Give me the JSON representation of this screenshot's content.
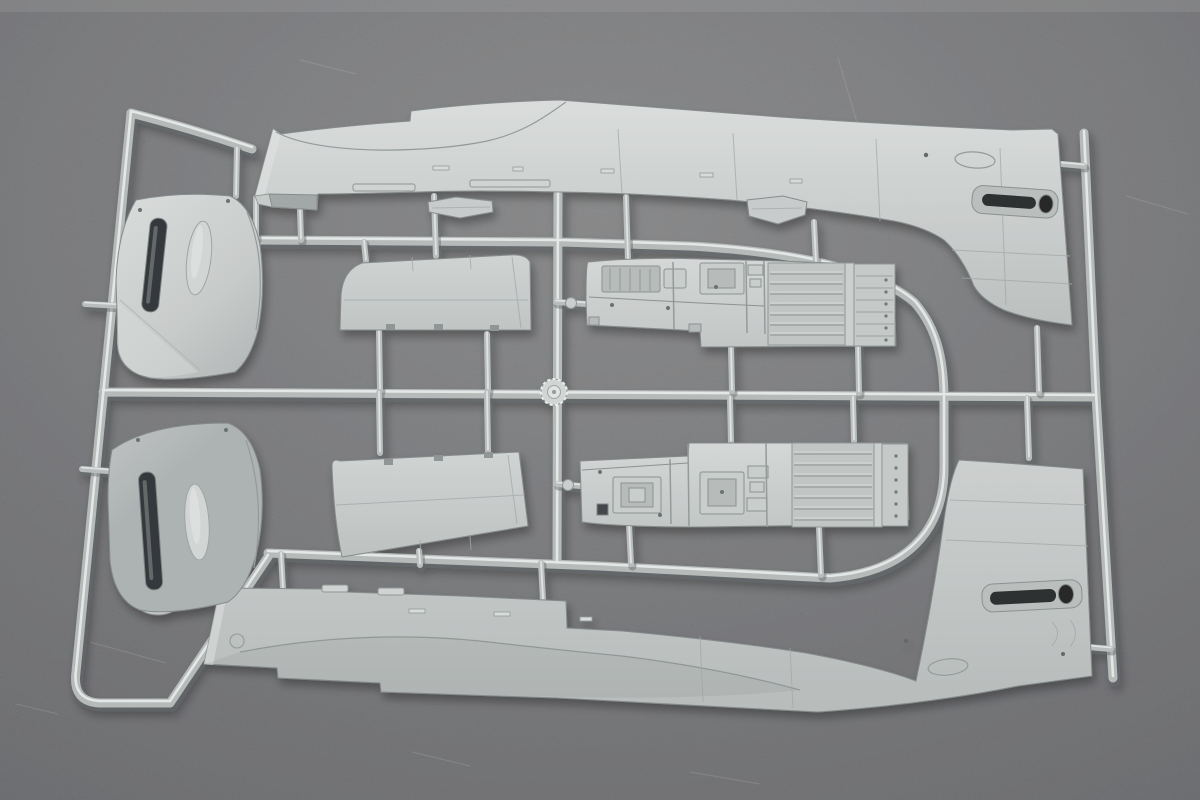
{
  "meta": {
    "domain": "natural-image",
    "type": "product-photograph",
    "subject": "Unassembled plastic scale-model aircraft kit sprue (injection-moulded runner with parts)",
    "alt_text": "Overhead photograph of a light grey injection-moulded model kit sprue lying on a dark grey textured surface. The runner frame holds two long fuselage halves with tail fins at top and bottom, two curved engine cowling side panels on the left, two trapezoidal wing flap panels in the centre-left, two ribbed cockpit sidewall floor panels in the centre, small bracket tabs, and a circular injection gate boss where the cross runners meet.",
    "background_surface": "dark grey mottled felt-like surface",
    "plastic_finish": "matte light grey styrene"
  },
  "palette": {
    "background": "#76777a",
    "background_top": "#8e8f91",
    "background_corner": "#616266",
    "plastic_base": "#c3c7c6",
    "plastic_highlight": "#dde1e0",
    "plastic_shadow": "#a6abab",
    "runner": "#b2b7b6",
    "runner_highlight": "#e7ebea",
    "recess_dark": "#2c2f30",
    "panel_line": "#8f9596"
  },
  "sprue": {
    "runner_shape": "outer frame with angled left rail, slanted right rail, central horizontal and vertical cross runners and a circular centre injection gate",
    "gate_boss": "knurled circular injection gate boss at runner crossing",
    "parts": [
      {
        "id": "fuselage-half-upper",
        "name": "Fuselage half with tail fin (upper)",
        "position": "top, spanning full width"
      },
      {
        "id": "fuselage-half-lower",
        "name": "Fuselage half with tail fin (lower, mirrored)",
        "position": "bottom, spanning full width"
      },
      {
        "id": "cowling-panel-upper",
        "name": "Engine cowling side panel with exhaust slot",
        "position": "upper left"
      },
      {
        "id": "cowling-panel-lower",
        "name": "Engine cowling side panel, mirrored",
        "position": "lower left"
      },
      {
        "id": "flap-panel-upper",
        "name": "Wing flap / control-surface panel",
        "position": "centre left, above mid runner"
      },
      {
        "id": "flap-panel-lower",
        "name": "Wing flap / control-surface panel, mirrored",
        "position": "centre left, below mid runner"
      },
      {
        "id": "cockpit-sidewall-upper",
        "name": "Cockpit sidewall and floor panel, ribbed",
        "position": "centre, above mid runner"
      },
      {
        "id": "cockpit-sidewall-lower",
        "name": "Cockpit sidewall and floor panel, mirrored",
        "position": "centre, below mid runner"
      },
      {
        "id": "bracket-tab-small",
        "name": "Small spar tab part",
        "position": "under upper fuselage, centre"
      },
      {
        "id": "bracket-tab-stepped",
        "name": "Small stepped bracket part",
        "position": "under upper fuselage, right of centre"
      }
    ]
  }
}
